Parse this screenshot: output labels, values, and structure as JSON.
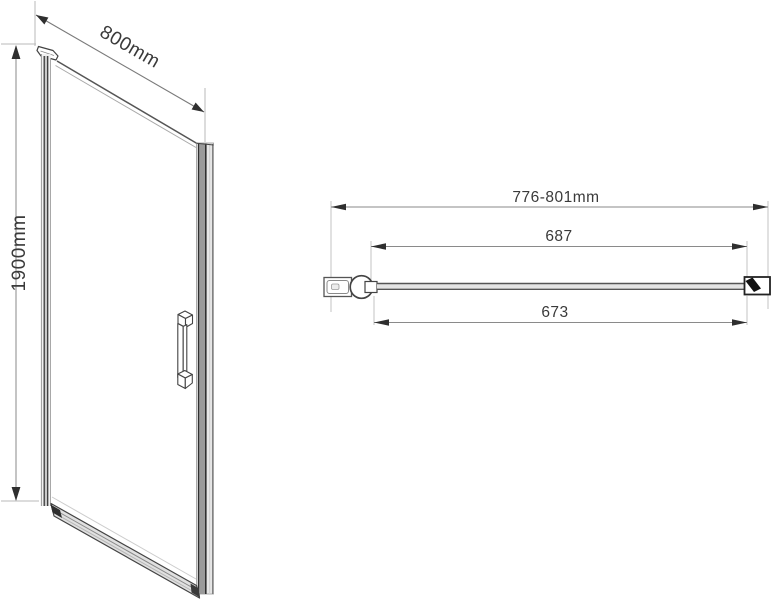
{
  "front_view": {
    "width_label": "800mm",
    "height_label": "1900mm"
  },
  "top_view": {
    "overall_width_label": "776-801mm",
    "frame_width_label": "687",
    "glass_width_label": "673"
  },
  "colors": {
    "background": "#ffffff",
    "line_dark": "#3a3a3a",
    "line_mid": "#8a8a8a",
    "line_light": "#b8b8b8",
    "arrow": "#2f2f2f",
    "text": "#3a3a3a",
    "metal_fill": "#c9c9c9",
    "seal_black": "#111111"
  }
}
